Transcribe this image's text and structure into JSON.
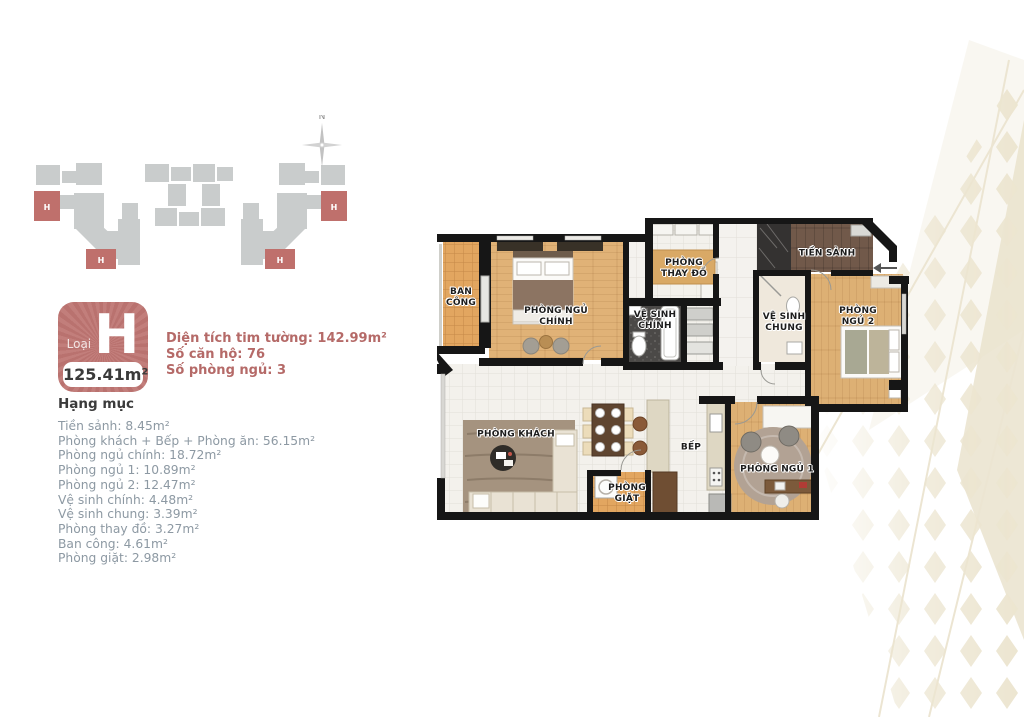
{
  "site_plan": {
    "compass_label": "N",
    "unit_marker": "H"
  },
  "badge": {
    "type_label": "Loại",
    "type_letter": "H",
    "area": "125.41m²"
  },
  "info": {
    "lines": [
      "Diện tích tim tường: 142.99m²",
      "Số căn hộ: 76",
      "Số phòng ngủ: 3"
    ]
  },
  "specs": {
    "title": "Hạng mục",
    "items": [
      "Tiền sảnh: 8.45m²",
      "Phòng khách + Bếp + Phòng ăn: 56.15m²",
      "Phòng ngủ chính: 18.72m²",
      "Phòng ngủ 1: 10.89m²",
      "Phòng ngủ 2: 12.47m²",
      "Vệ sinh chính: 4.48m²",
      "Vệ sinh chung: 3.39m²",
      "Phòng thay đồ: 3.27m²",
      "Ban công: 4.61m²",
      "Phòng giặt: 2.98m²"
    ]
  },
  "floor_plan": {
    "rooms": {
      "balcony": "BAN\nCÔNG",
      "master_bedroom": "PHÒNG NGỦ\nCHÍNH",
      "master_bath": "VỆ SINH\nCHÍNH",
      "closet": "PHÒNG\nTHAY ĐỒ",
      "foyer": "TIỀN SẢNH",
      "shared_bath": "VỆ SINH\nCHUNG",
      "bedroom_2": "PHÒNG NGỦ 2",
      "living": "PHÒNG KHÁCH",
      "kitchen": "BẾP",
      "laundry": "PHÒNG\nGIẶT",
      "bedroom_1": "PHÒNG NGỦ 1"
    }
  },
  "colors": {
    "accent": "#bd7471",
    "list_text": "#8d99a3",
    "wall": "#161616",
    "wood": "#dfb277",
    "balcony_tile": "#e2a660",
    "foyer_wood": "#6f5a49",
    "pattern_beige": "#ece5d0",
    "building_gray": "#c9cccc"
  }
}
